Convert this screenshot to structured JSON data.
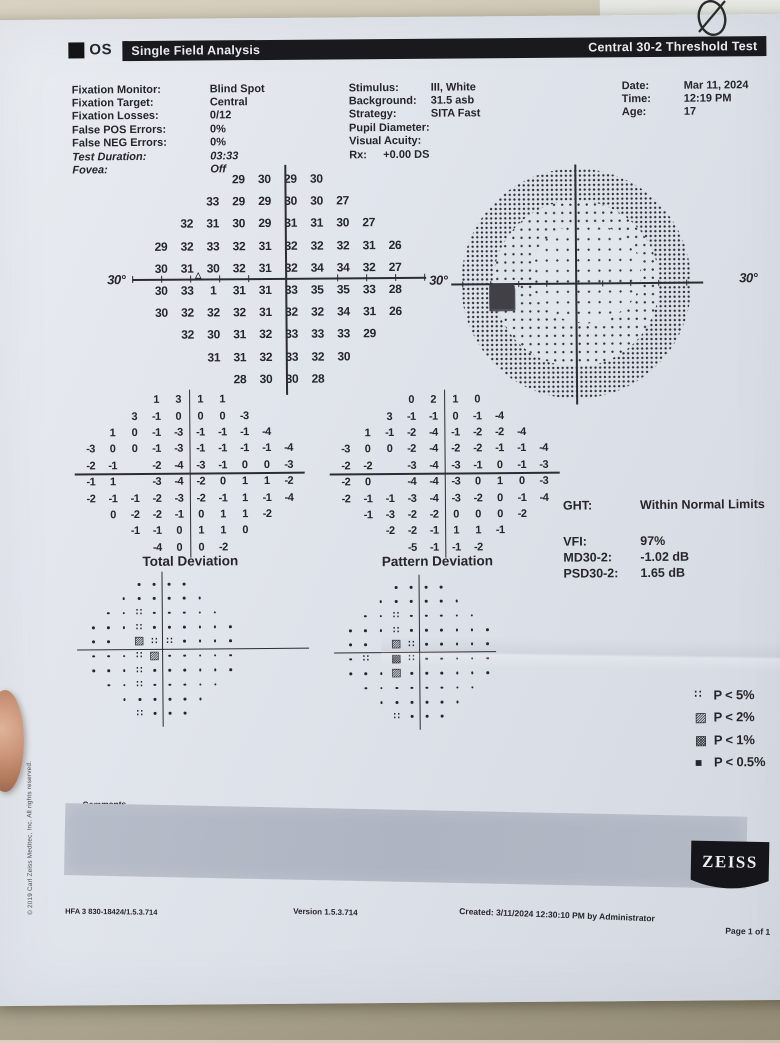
{
  "header": {
    "eye_label": "OS",
    "left_title": "Single Field Analysis",
    "right_title": "Central 30-2 Threshold Test"
  },
  "parameters": {
    "left": [
      {
        "label": "Fixation Monitor:",
        "value": "Blind Spot"
      },
      {
        "label": "Fixation Target:",
        "value": "Central"
      },
      {
        "label": "Fixation Losses:",
        "value": "0/12"
      },
      {
        "label": "False POS Errors:",
        "value": "0%"
      },
      {
        "label": "False NEG Errors:",
        "value": "0%"
      },
      {
        "label": "Test Duration:",
        "value": "03:33"
      },
      {
        "label": "Fovea:",
        "value": "Off"
      }
    ],
    "middle": [
      {
        "label": "Stimulus:",
        "value": "III, White"
      },
      {
        "label": "Background:",
        "value": "31.5 asb"
      },
      {
        "label": "Strategy:",
        "value": "SITA Fast"
      },
      {
        "label": "Pupil Diameter:",
        "value": ""
      },
      {
        "label": "Visual Acuity:",
        "value": ""
      },
      {
        "label": "Rx:",
        "value": "+0.00 DS"
      }
    ],
    "right": [
      {
        "label": "Date:",
        "value": "Mar 11, 2024"
      },
      {
        "label": "Time:",
        "value": "12:19 PM"
      },
      {
        "label": "Age:",
        "value": "17"
      }
    ]
  },
  "threshold_plot": {
    "axis_left": "30°",
    "axis_right": "30°",
    "blind_spot_marker": "△",
    "rows": [
      [
        "",
        "",
        "",
        "29",
        "30",
        "29",
        "30",
        "",
        "",
        ""
      ],
      [
        "",
        "",
        "33",
        "29",
        "29",
        "30",
        "30",
        "27",
        "",
        ""
      ],
      [
        "",
        "32",
        "31",
        "30",
        "29",
        "31",
        "31",
        "30",
        "27",
        ""
      ],
      [
        "29",
        "32",
        "33",
        "32",
        "31",
        "32",
        "32",
        "32",
        "31",
        "26"
      ],
      [
        "30",
        "31",
        "30",
        "32",
        "31",
        "32",
        "34",
        "34",
        "32",
        "27"
      ],
      [
        "30",
        "33",
        "1",
        "31",
        "31",
        "33",
        "35",
        "35",
        "33",
        "28"
      ],
      [
        "30",
        "32",
        "32",
        "32",
        "31",
        "32",
        "32",
        "34",
        "31",
        "26"
      ],
      [
        "",
        "32",
        "30",
        "31",
        "32",
        "33",
        "33",
        "33",
        "29",
        ""
      ],
      [
        "",
        "",
        "31",
        "31",
        "32",
        "33",
        "32",
        "30",
        "",
        ""
      ],
      [
        "",
        "",
        "",
        "28",
        "30",
        "30",
        "28",
        "",
        "",
        ""
      ]
    ]
  },
  "grayscale_plot": {
    "axis_label": "30°"
  },
  "total_deviation": {
    "title": "Total Deviation",
    "rows": [
      [
        "",
        "",
        "",
        "1",
        "3",
        "1",
        "1",
        "",
        "",
        ""
      ],
      [
        "",
        "",
        "3",
        "-1",
        "0",
        "0",
        "0",
        "-3",
        "",
        ""
      ],
      [
        "",
        "1",
        "0",
        "-1",
        "-3",
        "-1",
        "-1",
        "-1",
        "-4",
        ""
      ],
      [
        "-3",
        "0",
        "0",
        "-1",
        "-3",
        "-1",
        "-1",
        "-1",
        "-1",
        "-4"
      ],
      [
        "-2",
        "-1",
        "",
        "-2",
        "-4",
        "-3",
        "-1",
        "0",
        "0",
        "-3"
      ],
      [
        "-1",
        "1",
        "",
        "-3",
        "-4",
        "-2",
        "0",
        "1",
        "1",
        "-2"
      ],
      [
        "-2",
        "-1",
        "-1",
        "-2",
        "-3",
        "-2",
        "-1",
        "1",
        "-1",
        "-4"
      ],
      [
        "",
        "0",
        "-2",
        "-2",
        "-1",
        "0",
        "1",
        "1",
        "-2",
        ""
      ],
      [
        "",
        "",
        "-1",
        "-1",
        "0",
        "1",
        "1",
        "0",
        "",
        ""
      ],
      [
        "",
        "",
        "",
        "-4",
        "0",
        "0",
        "-2",
        "",
        "",
        ""
      ]
    ],
    "prob_rows": [
      [
        "",
        "",
        "",
        ".",
        ".",
        ".",
        ".",
        "",
        "",
        ""
      ],
      [
        "",
        "",
        ".",
        ".",
        ".",
        ".",
        ".",
        ".",
        "",
        ""
      ],
      [
        "",
        ".",
        ".",
        "::",
        ".",
        ".",
        ".",
        ".",
        ".",
        ""
      ],
      [
        ".",
        ".",
        ".",
        "::",
        ".",
        ".",
        ".",
        ".",
        ".",
        "."
      ],
      [
        ".",
        ".",
        "",
        "h2",
        "::",
        "::",
        ".",
        ".",
        ".",
        "."
      ],
      [
        ".",
        ".",
        ".",
        "::",
        "h2",
        ".",
        ".",
        ".",
        ".",
        "."
      ],
      [
        ".",
        ".",
        ".",
        "::",
        ".",
        ".",
        ".",
        ".",
        ".",
        "."
      ],
      [
        "",
        ".",
        ".",
        "::",
        ".",
        ".",
        ".",
        ".",
        ".",
        ""
      ],
      [
        "",
        "",
        ".",
        ".",
        ".",
        ".",
        ".",
        ".",
        "",
        ""
      ],
      [
        "",
        "",
        "",
        "::",
        ".",
        ".",
        ".",
        "",
        "",
        ""
      ]
    ]
  },
  "pattern_deviation": {
    "title": "Pattern Deviation",
    "rows": [
      [
        "",
        "",
        "",
        "0",
        "2",
        "1",
        "0",
        "",
        "",
        ""
      ],
      [
        "",
        "",
        "3",
        "-1",
        "-1",
        "0",
        "-1",
        "-4",
        "",
        ""
      ],
      [
        "",
        "1",
        "-1",
        "-2",
        "-4",
        "-1",
        "-2",
        "-2",
        "-4",
        ""
      ],
      [
        "-3",
        "0",
        "0",
        "-2",
        "-4",
        "-2",
        "-2",
        "-1",
        "-1",
        "-4"
      ],
      [
        "-2",
        "-2",
        "",
        "-3",
        "-4",
        "-3",
        "-1",
        "0",
        "-1",
        "-3"
      ],
      [
        "-2",
        "0",
        "",
        "-4",
        "-4",
        "-3",
        "0",
        "1",
        "0",
        "-3"
      ],
      [
        "-2",
        "-1",
        "-1",
        "-3",
        "-4",
        "-3",
        "-2",
        "0",
        "-1",
        "-4"
      ],
      [
        "",
        "-1",
        "-3",
        "-2",
        "-2",
        "0",
        "0",
        "0",
        "-2",
        ""
      ],
      [
        "",
        "",
        "-2",
        "-2",
        "-1",
        "1",
        "1",
        "-1",
        "",
        ""
      ],
      [
        "",
        "",
        "",
        "-5",
        "-1",
        "-1",
        "-2",
        "",
        "",
        ""
      ]
    ],
    "prob_rows": [
      [
        "",
        "",
        "",
        ".",
        ".",
        ".",
        ".",
        "",
        "",
        ""
      ],
      [
        "",
        "",
        ".",
        ".",
        ".",
        ".",
        ".",
        ".",
        "",
        ""
      ],
      [
        "",
        ".",
        ".",
        "::",
        ".",
        ".",
        ".",
        ".",
        ".",
        ""
      ],
      [
        ".",
        ".",
        ".",
        "::",
        ".",
        ".",
        ".",
        ".",
        ".",
        "."
      ],
      [
        ".",
        ".",
        "",
        "h2",
        "::",
        ".",
        ".",
        ".",
        ".",
        "."
      ],
      [
        ".",
        "::",
        "",
        "h1",
        "::",
        ".",
        ".",
        ".",
        ".",
        "."
      ],
      [
        ".",
        ".",
        ".",
        "h2",
        ".",
        ".",
        ".",
        ".",
        ".",
        "."
      ],
      [
        "",
        ".",
        ".",
        ".",
        ".",
        ".",
        ".",
        ".",
        ".",
        ""
      ],
      [
        "",
        "",
        ".",
        ".",
        ".",
        ".",
        ".",
        ".",
        "",
        ""
      ],
      [
        "",
        "",
        "",
        "::",
        ".",
        ".",
        ".",
        "",
        "",
        ""
      ]
    ]
  },
  "summary": {
    "ght": {
      "label": "GHT:",
      "value": "Within Normal Limits"
    },
    "vfi": {
      "label": "VFI:",
      "value": "97%"
    },
    "md": {
      "label": "MD30-2:",
      "value": "-1.02 dB"
    },
    "psd": {
      "label": "PSD30-2:",
      "value": "1.65 dB"
    }
  },
  "legend": {
    "items": [
      {
        "symbol": "p5",
        "label": "P < 5%"
      },
      {
        "symbol": "p2",
        "label": "P < 2%"
      },
      {
        "symbol": "p1",
        "label": "P < 1%"
      },
      {
        "symbol": "p05",
        "label": "P < 0.5%"
      }
    ]
  },
  "comments": {
    "label": "Comments"
  },
  "footer": {
    "device": "HFA 3 830-18424/1.5.3.714",
    "version": "Version 1.5.3.714",
    "created": "Created: 3/11/2024 12:30:10 PM by Administrator",
    "brand": "ZEISS",
    "page": "Page 1 of 1"
  },
  "copyright": "© 2019 Carl Zeiss Meditec, Inc. All rights reserved."
}
